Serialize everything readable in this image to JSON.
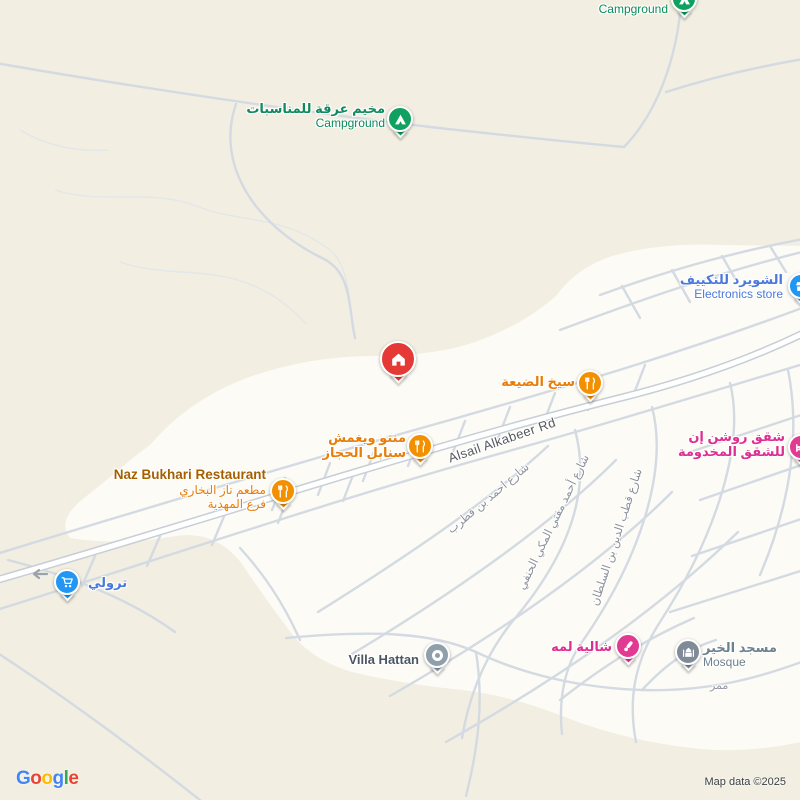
{
  "pois": {
    "campground_top": {
      "en": "Campground"
    },
    "campground_arqa": {
      "ar": "مخيم عرقة للمناسبات",
      "en": "Campground"
    },
    "electronics": {
      "ar": "الشويرد للتكييف",
      "en": "Electronics store"
    },
    "seekh_aldeyah": {
      "ar": "سيخ الضيعة"
    },
    "manto": {
      "ar1": "منتو ويغمش",
      "ar2": "سنابل الحجاز"
    },
    "naz_bukhari": {
      "en": "Naz Bukhari Restaurant",
      "ar1": "مطعم ناز البخاري",
      "ar2": "فرع المهدية"
    },
    "trolley": {
      "ar": "ترولي"
    },
    "villa_hattan": {
      "en": "Villa Hattan"
    },
    "chalet_lamah": {
      "ar": "شالية لمه"
    },
    "mosque_alkhair": {
      "ar": "مسجد الخير",
      "en": "Mosque"
    },
    "roshan_inn": {
      "ar1": "شقق روشن إن",
      "ar2": "للشقق المخدومة"
    }
  },
  "streets": {
    "alsail": "Alsail Alkabeer Rd",
    "qutrub": "شارع احمد بن قطرب",
    "makki_hanafi": "شارع أحمد مفتي المكي الحنفي",
    "qutb_sultan": "شارع قطب الدين بن السلطان",
    "mamar": "ممر"
  },
  "footer": {
    "logo": [
      {
        "ch": "G",
        "style": "color:#4285F4"
      },
      {
        "ch": "o",
        "style": "color:#EA4335"
      },
      {
        "ch": "o",
        "style": "color:#FBBC05"
      },
      {
        "ch": "g",
        "style": "color:#4285F4"
      },
      {
        "ch": "l",
        "style": "color:#34A853"
      },
      {
        "ch": "e",
        "style": "color:#EA4335"
      }
    ],
    "attribution": "Map data ©2025"
  },
  "colors": {
    "map_background": "#f2eee1",
    "built_area": "#fcfbf6",
    "road_minor": "#d4dae2",
    "road_main_casing": "#c7ced6",
    "poi_green": "#0e8a5c",
    "poi_orange": "#e87d09",
    "poi_blue": "#4a78dc",
    "poi_pink": "#dd2e92",
    "poi_gray": "#6d828f",
    "pin_green": "#10a060",
    "pin_orange": "#f39000",
    "pin_blue": "#2196f3",
    "pin_pink": "#e23a92",
    "pin_red": "#e53935",
    "pin_gray": "#8fa0ab"
  }
}
